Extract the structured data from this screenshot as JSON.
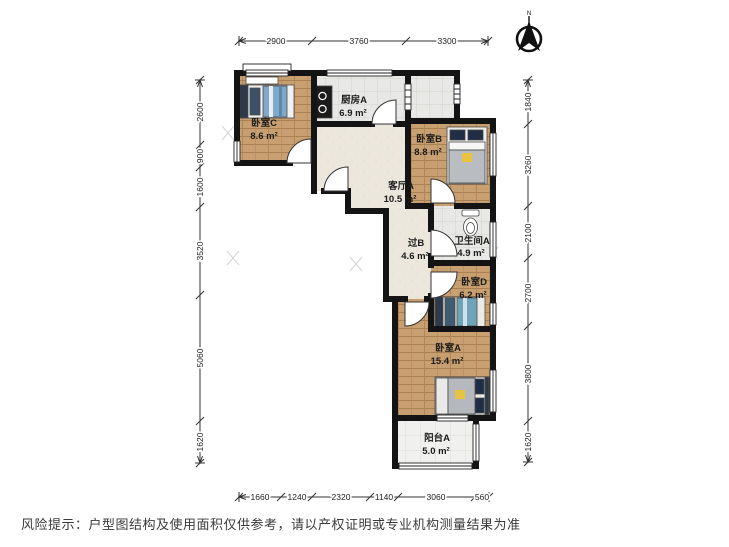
{
  "disclaimer": "风险提示：户型图结构及使用面积仅供参考，请以产权证明或专业机构测量结果为准",
  "compass": {
    "label": "N"
  },
  "rooms": {
    "bedroom_c": {
      "name": "卧室C",
      "area": "8.6 m²"
    },
    "kitchen_a": {
      "name": "厨房A",
      "area": "6.9 m²"
    },
    "bedroom_b": {
      "name": "卧室B",
      "area": "8.8 m²"
    },
    "living_a": {
      "name": "客厅A",
      "area": "10.5 m²"
    },
    "hall_b": {
      "name": "过B",
      "area": "4.6 m²"
    },
    "bath_a": {
      "name": "卫生间A",
      "area": "4.9 m²"
    },
    "bedroom_d": {
      "name": "卧室D",
      "area": "6.2 m²"
    },
    "bedroom_a": {
      "name": "卧室A",
      "area": "15.4 m²"
    },
    "balcony_a": {
      "name": "阳台A",
      "area": "5.0 m²"
    }
  },
  "dimensions": {
    "top": [
      "2900",
      "3760",
      "3300"
    ],
    "left": [
      "2600",
      "900",
      "1600",
      "3520",
      "5060",
      "1620"
    ],
    "right": [
      "1840",
      "3260",
      "2100",
      "2700",
      "3800",
      "1620"
    ],
    "bottom": [
      "1660",
      "1240",
      "2320",
      "1140",
      "3060",
      "560"
    ]
  },
  "colors": {
    "wall": "#141414",
    "wood_floor": "#c89f70",
    "tile_floor": "#e8e8e6",
    "living_floor": "#ece7dc",
    "accent_blanket_blue": "#7fa8c9",
    "accent_pillow_navy": "#1f2d45",
    "accent_yellow": "#e8c341"
  }
}
